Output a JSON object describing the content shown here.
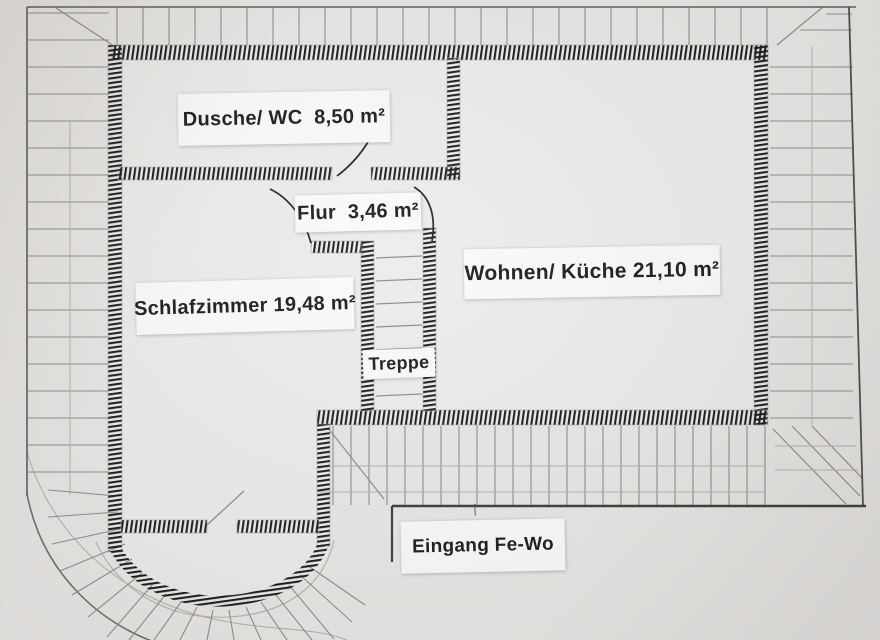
{
  "plan": {
    "kind": "hand-drawn floor plan photo",
    "labels": {
      "dusche_wc": {
        "text": "Dusche/ WC  8,50 m²"
      },
      "flur": {
        "text": "Flur  3,46 m²"
      },
      "wohnen_kueche": {
        "text": "Wohnen/ Küche 21,10 m²"
      },
      "schlafzimmer": {
        "text": "Schlafzimmer 19,48 m²"
      },
      "treppe": {
        "text": "Treppe"
      },
      "eingang": {
        "text": "Eingang Fe-Wo"
      }
    },
    "entrance_arrow": {
      "glyph": "↑",
      "direction": "up"
    },
    "colors": {
      "paper": "#e9e7e5",
      "room_interior": "#edecea",
      "label_paper": "#fbfaf9",
      "ink_walls": "#1a1a1a",
      "pencil": "#8f8d8a",
      "pencil_faint": "#b5b2ae",
      "border_dark": "#3f3d3a"
    }
  }
}
